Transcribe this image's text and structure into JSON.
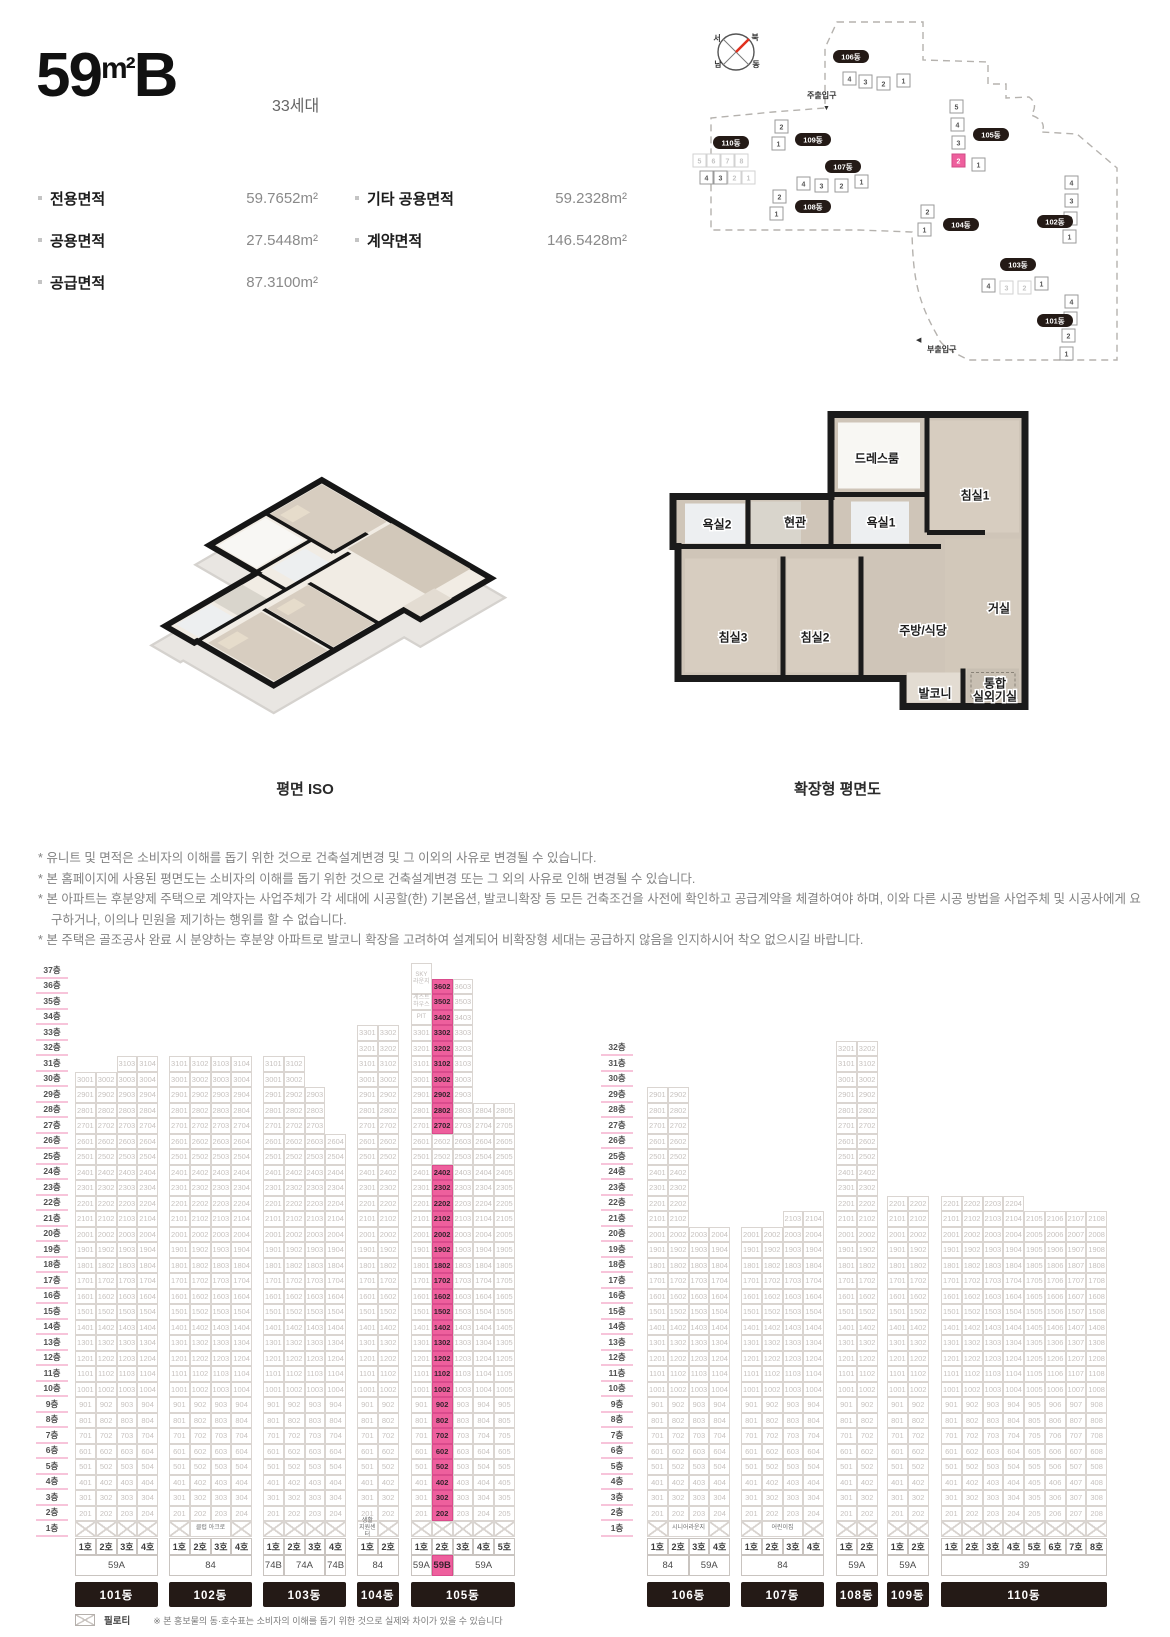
{
  "header": {
    "title_num": "59",
    "title_unit": "m²",
    "title_suffix": "B",
    "households": "33세대"
  },
  "areas": {
    "col1": [
      {
        "label": "전용면적",
        "value": "59.7652m²"
      },
      {
        "label": "공용면적",
        "value": "27.5448m²"
      },
      {
        "label": "공급면적",
        "value": "87.3100m²"
      }
    ],
    "col2": [
      {
        "label": "기타 공용면적",
        "value": "59.2328m²"
      },
      {
        "label": "계약면적",
        "value": "146.5428m²"
      }
    ]
  },
  "site_map": {
    "compass": {
      "labels": [
        {
          "t": "서",
          "x": 62,
          "y": 33
        },
        {
          "t": "북",
          "x": 100,
          "y": 32
        },
        {
          "t": "남",
          "x": 63,
          "y": 59
        },
        {
          "t": "동",
          "x": 101,
          "y": 59
        }
      ]
    },
    "entrances": [
      {
        "label": "주출입구",
        "x": 152,
        "y": 90,
        "arrow": "▼",
        "ax": 168,
        "ay": 102
      },
      {
        "label": "부출입구",
        "x": 272,
        "y": 344,
        "arrow": "◀",
        "ax": 261,
        "ay": 334
      }
    ],
    "buildings": [
      {
        "name": "106동",
        "pill": {
          "x": 178,
          "y": 42
        },
        "units": [
          {
            "n": "4",
            "x": 188,
            "y": 64
          },
          {
            "n": "3",
            "x": 204,
            "y": 67
          },
          {
            "n": "2",
            "x": 222,
            "y": 69
          },
          {
            "n": "1",
            "x": 242,
            "y": 66
          }
        ]
      },
      {
        "name": "109동",
        "pill": {
          "x": 140,
          "y": 125
        },
        "units": [
          {
            "n": "2",
            "x": 120,
            "y": 112
          },
          {
            "n": "1",
            "x": 117,
            "y": 129
          }
        ]
      },
      {
        "name": "110동",
        "pill": {
          "x": 58,
          "y": 128
        },
        "units": [
          {
            "n": "5",
            "x": 38,
            "y": 146,
            "faded": true
          },
          {
            "n": "6",
            "x": 52,
            "y": 146,
            "faded": true
          },
          {
            "n": "7",
            "x": 66,
            "y": 146,
            "faded": true
          },
          {
            "n": "8",
            "x": 80,
            "y": 146,
            "faded": true
          },
          {
            "n": "4",
            "x": 45,
            "y": 163
          },
          {
            "n": "3",
            "x": 59,
            "y": 163
          },
          {
            "n": "2",
            "x": 73,
            "y": 163,
            "faded": true
          },
          {
            "n": "1",
            "x": 87,
            "y": 163,
            "faded": true
          }
        ]
      },
      {
        "name": "107동",
        "pill": {
          "x": 170,
          "y": 152
        },
        "units": [
          {
            "n": "4",
            "x": 142,
            "y": 169
          },
          {
            "n": "3",
            "x": 160,
            "y": 171
          },
          {
            "n": "2",
            "x": 180,
            "y": 171
          },
          {
            "n": "1",
            "x": 200,
            "y": 167
          }
        ]
      },
      {
        "name": "108동",
        "pill": {
          "x": 140,
          "y": 192
        },
        "units": [
          {
            "n": "2",
            "x": 118,
            "y": 182
          },
          {
            "n": "1",
            "x": 115,
            "y": 199
          }
        ]
      },
      {
        "name": "105동",
        "pill": {
          "x": 318,
          "y": 120
        },
        "units": [
          {
            "n": "5",
            "x": 295,
            "y": 92
          },
          {
            "n": "4",
            "x": 296,
            "y": 110
          },
          {
            "n": "3",
            "x": 297,
            "y": 128
          },
          {
            "n": "2",
            "x": 297,
            "y": 146,
            "highlight": true
          },
          {
            "n": "1",
            "x": 317,
            "y": 150
          }
        ]
      },
      {
        "name": "104동",
        "pill": {
          "x": 288,
          "y": 210
        },
        "units": [
          {
            "n": "2",
            "x": 266,
            "y": 197
          },
          {
            "n": "1",
            "x": 263,
            "y": 215
          }
        ]
      },
      {
        "name": "102동",
        "pill": {
          "x": 382,
          "y": 207
        },
        "units": [
          {
            "n": "4",
            "x": 410,
            "y": 168
          },
          {
            "n": "3",
            "x": 410,
            "y": 186
          },
          {
            "n": "2",
            "x": 409,
            "y": 204
          },
          {
            "n": "1",
            "x": 408,
            "y": 222
          }
        ]
      },
      {
        "name": "103동",
        "pill": {
          "x": 345,
          "y": 250
        },
        "units": [
          {
            "n": "4",
            "x": 327,
            "y": 271
          },
          {
            "n": "3",
            "x": 345,
            "y": 273,
            "faded": true
          },
          {
            "n": "2",
            "x": 363,
            "y": 273,
            "faded": true
          },
          {
            "n": "1",
            "x": 380,
            "y": 269
          }
        ]
      },
      {
        "name": "101동",
        "pill": {
          "x": 382,
          "y": 306
        },
        "units": [
          {
            "n": "4",
            "x": 410,
            "y": 287
          },
          {
            "n": "3",
            "x": 409,
            "y": 304
          },
          {
            "n": "2",
            "x": 407,
            "y": 321
          },
          {
            "n": "1",
            "x": 405,
            "y": 339
          }
        ]
      }
    ]
  },
  "plans": {
    "iso_caption": "평면 ISO",
    "ext_caption": "확장형 평면도",
    "ext_rooms": [
      {
        "label": "드레스룸",
        "x": 232,
        "y": 56
      },
      {
        "label": "침실1",
        "x": 330,
        "y": 93
      },
      {
        "label": "욕실2",
        "x": 72,
        "y": 122
      },
      {
        "label": "현관",
        "x": 150,
        "y": 120
      },
      {
        "label": "욕실1",
        "x": 236,
        "y": 120
      },
      {
        "label": "침실3",
        "x": 88,
        "y": 235
      },
      {
        "label": "침실2",
        "x": 170,
        "y": 235
      },
      {
        "label": "주방/식당",
        "x": 278,
        "y": 228
      },
      {
        "label": "거실",
        "x": 354,
        "y": 206
      },
      {
        "label": "발코니",
        "x": 290,
        "y": 291
      },
      {
        "label": "통합\n실외기실",
        "x": 350,
        "y": 281
      }
    ]
  },
  "disclaimer_bullet": "*",
  "disclaimers": [
    "유니트 및 면적은 소비자의 이해를 돕기 위한 것으로 건축설계변경 및 그 이외의 사유로 변경될 수 있습니다.",
    "본 홈페이지에 사용된 평면도는 소비자의 이해를 돕기 위한 것으로 건축설계변경 또는 그 외의 사유로 인해 변경될 수 있습니다.",
    "본 아파트는 후분양제 주택으로 계약자는 사업주체가 각 세대에 시공할(한) 기본옵션, 발코니확장 등 모든 건축조건을 사전에 확인하고 공급계약을 체결하여야 하며, 이와 다른 시공 방법을 사업주체 및 시공사에게 요구하거나, 이의나 민원을 제기하는 행위를 할 수 없습니다.",
    "본 주택은 골조공사 완료 시 분양하는 후분양 아파트로 발코니 확장을 고려하여 설계되어 비확장형 세대는 공급하지 않음을 인지하시어 착오 없으시길 바랍니다."
  ],
  "stack_chart": {
    "row_h": 15.5,
    "cell_w": 20.75,
    "top_floor": 37,
    "floor_suffix": "층",
    "unit_suffix": "호",
    "axes": [
      {
        "x": 36,
        "w": 32,
        "top": 37
      },
      {
        "x": 601,
        "w": 32,
        "top": 32
      }
    ],
    "buildings": [
      {
        "name": "101동",
        "x": 75,
        "cols": [
          {
            "ho": 1,
            "top": 30
          },
          {
            "ho": 2,
            "top": 30
          },
          {
            "ho": 3,
            "top": 31
          },
          {
            "ho": 4,
            "top": 31
          }
        ],
        "types": [
          {
            "label": "59A",
            "span": 4
          }
        ],
        "ground": [
          "x",
          "x",
          "x",
          "x"
        ]
      },
      {
        "name": "102동",
        "x": 169,
        "cols": [
          {
            "ho": 1,
            "top": 31
          },
          {
            "ho": 2,
            "top": 31
          },
          {
            "ho": 3,
            "top": 31
          },
          {
            "ho": 4,
            "top": 31
          }
        ],
        "types": [
          {
            "label": "84",
            "span": 4
          }
        ],
        "ground": [
          "x",
          {
            "text": "클럽 아크로",
            "span": 2
          },
          "x"
        ]
      },
      {
        "name": "103동",
        "x": 263,
        "cols": [
          {
            "ho": 1,
            "top": 31
          },
          {
            "ho": 2,
            "top": 31
          },
          {
            "ho": 3,
            "top": 29
          },
          {
            "ho": 4,
            "top": 26
          }
        ],
        "types": [
          {
            "label": "74B",
            "span": 1
          },
          {
            "label": "74A",
            "span": 2
          },
          {
            "label": "74B",
            "span": 1
          }
        ],
        "ground": [
          "x",
          "x",
          "x",
          "x"
        ]
      },
      {
        "name": "104동",
        "x": 357,
        "cols": [
          {
            "ho": 1,
            "top": 33
          },
          {
            "ho": 2,
            "top": 33
          }
        ],
        "types": [
          {
            "label": "84",
            "span": 2
          }
        ],
        "ground": [
          {
            "text": "생활\n지원센터",
            "span": 1
          },
          "x"
        ]
      },
      {
        "name": "105동",
        "x": 411,
        "cols": [
          {
            "ho": 1,
            "top": 33
          },
          {
            "ho": 2,
            "top": 36,
            "highlight": true,
            "exclude": [
              25,
              26
            ]
          },
          {
            "ho": 3,
            "top": 36
          },
          {
            "ho": 4,
            "top": 28
          },
          {
            "ho": 5,
            "top": 28
          }
        ],
        "specials": [
          {
            "col": 1,
            "floor": 37,
            "rows": 2,
            "label": "SKY\n라운지"
          },
          {
            "col": 1,
            "floor": 35,
            "rows": 1,
            "label": "게스트\n하우스"
          },
          {
            "col": 1,
            "floor": 34,
            "rows": 1,
            "label": "PIT"
          }
        ],
        "types": [
          {
            "label": "59A",
            "span": 1
          },
          {
            "label": "59B",
            "span": 1,
            "highlight": true
          },
          {
            "label": "59A",
            "span": 3
          }
        ],
        "ground": [
          "x",
          "x",
          "x",
          "x",
          "x"
        ]
      },
      {
        "name": "106동",
        "x": 647,
        "cols": [
          {
            "ho": 1,
            "top": 29
          },
          {
            "ho": 2,
            "top": 29
          },
          {
            "ho": 3,
            "top": 20
          },
          {
            "ho": 4,
            "top": 20
          }
        ],
        "types": [
          {
            "label": "84",
            "span": 2
          },
          {
            "label": "59A",
            "span": 2
          }
        ],
        "ground": [
          "x",
          {
            "text": "시니어라운지",
            "span": 2
          },
          "x"
        ]
      },
      {
        "name": "107동",
        "x": 741,
        "cols": [
          {
            "ho": 1,
            "top": 20
          },
          {
            "ho": 2,
            "top": 20
          },
          {
            "ho": 3,
            "top": 21
          },
          {
            "ho": 4,
            "top": 21
          }
        ],
        "types": [
          {
            "label": "84",
            "span": 4
          }
        ],
        "ground": [
          "x",
          {
            "text": "어린이집",
            "span": 2
          },
          "x"
        ]
      },
      {
        "name": "108동",
        "x": 836,
        "cols": [
          {
            "ho": 1,
            "top": 32
          },
          {
            "ho": 2,
            "top": 32
          }
        ],
        "types": [
          {
            "label": "59A",
            "span": 2
          }
        ],
        "ground": [
          "x",
          "x"
        ]
      },
      {
        "name": "109동",
        "x": 887,
        "cols": [
          {
            "ho": 1,
            "top": 22
          },
          {
            "ho": 2,
            "top": 22
          }
        ],
        "types": [
          {
            "label": "59A",
            "span": 2
          }
        ],
        "ground": [
          "x",
          "x"
        ]
      },
      {
        "name": "110동",
        "x": 941,
        "cols": [
          {
            "ho": 1,
            "top": 22
          },
          {
            "ho": 2,
            "top": 22
          },
          {
            "ho": 3,
            "top": 22
          },
          {
            "ho": 4,
            "top": 22
          },
          {
            "ho": 5,
            "top": 21
          },
          {
            "ho": 6,
            "top": 21
          },
          {
            "ho": 7,
            "top": 21
          },
          {
            "ho": 8,
            "top": 21
          }
        ],
        "types": [
          {
            "label": "39",
            "span": 8
          }
        ],
        "ground": [
          "x",
          "x",
          "x",
          "x",
          "x",
          "x",
          "x",
          "x"
        ]
      }
    ],
    "legend": {
      "piloti": "필로티",
      "note": "※ 본 홍보물의 동·호수표는 소비자의 이해를 돕기 위한 것으로 실제와 차이가 있을 수 있습니다"
    }
  }
}
